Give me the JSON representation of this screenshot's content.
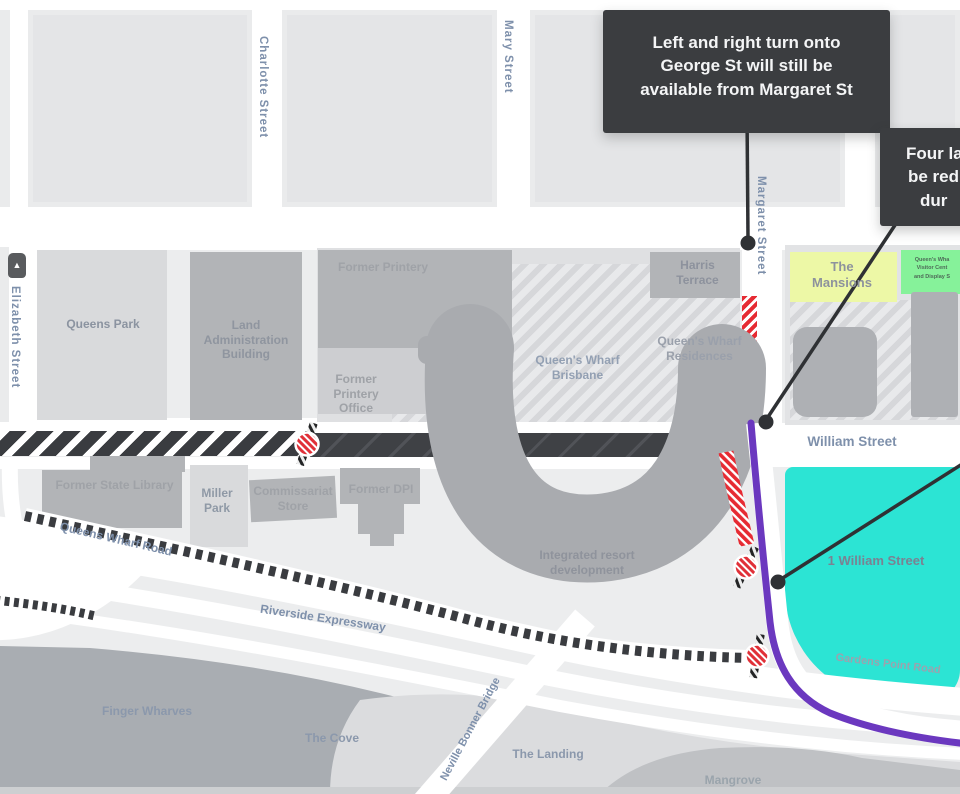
{
  "streets": {
    "charlotte": "Charlotte Street",
    "mary": "Mary Street",
    "elizabeth": "Elizabeth Street",
    "margaret": "Margaret Street",
    "william": "William Street",
    "queens_wharf_road": "Queens Wharf Road",
    "riverside_expressway": "Riverside Expressway",
    "gardens_point_road": "Gardens Point Road",
    "neville_bonner_bridge": "Neville Bonner Bridge"
  },
  "places": {
    "queens_park": "Queens Park",
    "land_administration_building": "Land Administration Building",
    "former_printery": "Former Printery",
    "former_printery_office": "Former Printery Office",
    "harris_terrace": "Harris Terrace",
    "queens_wharf_brisbane": "Queen's Wharf Brisbane",
    "queens_wharf_residences": "Queen's Wharf Residences",
    "the_mansions": "The Mansions",
    "visitor_lines": [
      "Queen's Wha",
      "Visitor Cent",
      "and Display S"
    ],
    "former_state_library": "Former State Library",
    "miller_park": "Miller Park",
    "commissariat_store": "Commissariat Store",
    "former_dpi": "Former DPI",
    "integrated_resort": "Integrated resort development",
    "one_william_street": "1 William Street",
    "finger_wharves": "Finger Wharves",
    "the_cove": "The Cove",
    "the_landing": "The Landing",
    "mangrove": "Mangrove"
  },
  "callouts": {
    "margaret_turns_lines": [
      "Left and right turn onto",
      "George St will still be",
      "available from Margaret St"
    ],
    "four_lanes_lines": [
      "Four la",
      "be red",
      "dur"
    ]
  },
  "colors": {
    "closure_red": "#e62b33",
    "route_purple": "#6b38bf",
    "highlight_cyan": "#2ce4d4",
    "mansions_yellow": "#edf8a6",
    "visitor_green": "#86f29a",
    "road_dark": "#3f4145",
    "river_gray": "#a9adb2",
    "callout_bg": "#3b3d40"
  }
}
